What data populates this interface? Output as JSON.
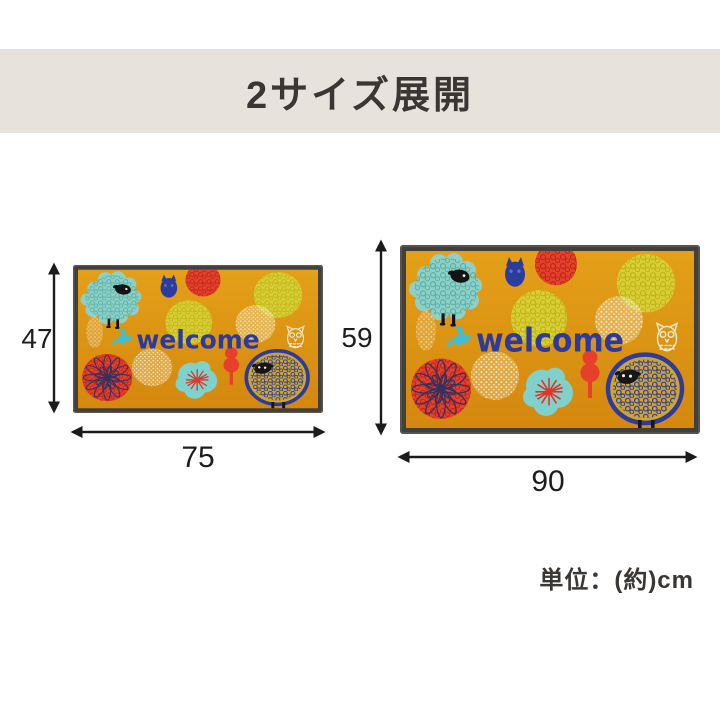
{
  "header": {
    "title": "2サイズ展開"
  },
  "mat": {
    "welcome_text": "welcome",
    "motifs": [
      "teal-sheep",
      "navy-sheep",
      "blue-owl",
      "white-owl",
      "teal-bird",
      "red-dahlia",
      "pompom-flowers",
      "red-tree"
    ],
    "base_color": "#DC9411",
    "border_color": "#43403C",
    "accent_colors": {
      "navy": "#2B3A9E",
      "teal": "#8ED0C7",
      "red": "#E6402C",
      "yellow": "#D7CF35",
      "cream": "#F0E4BF"
    }
  },
  "sizes": {
    "small": {
      "height_cm": "47",
      "width_cm": "75"
    },
    "large": {
      "height_cm": "59",
      "width_cm": "90"
    }
  },
  "unit_note": "単位：(約)cm",
  "ui_colors": {
    "header_bg": "#E8E2DD",
    "heading_text": "#3A3633",
    "dimension_text": "#1D1D1D",
    "background": "#FFFFFF",
    "arrow": "#1B1B1B"
  }
}
